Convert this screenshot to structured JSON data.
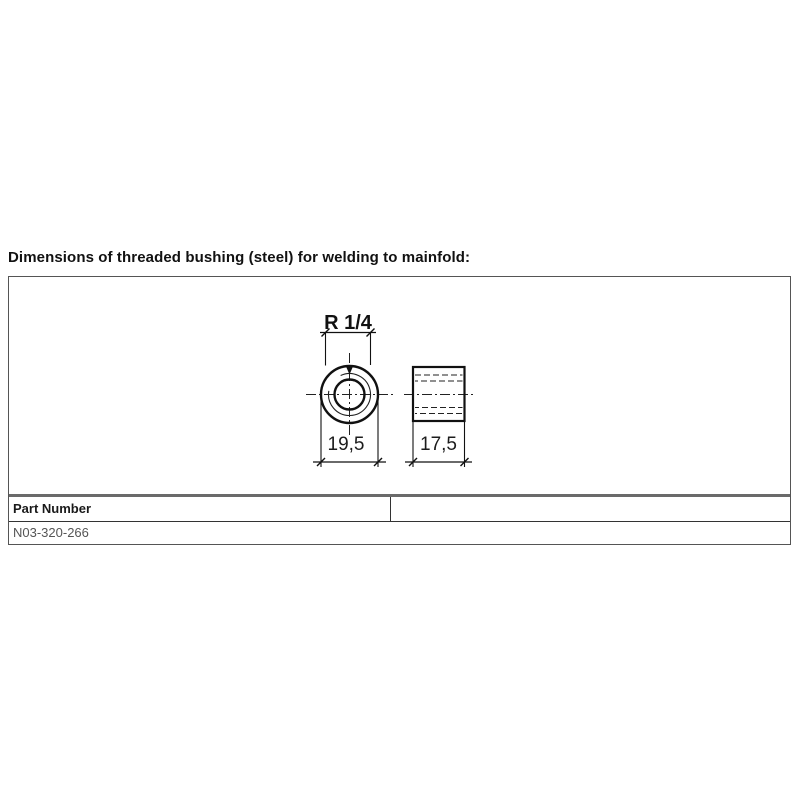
{
  "page": {
    "title": "Dimensions of threaded bushing (steel) for welding to mainfold:"
  },
  "drawing": {
    "thread_label": "R 1/4",
    "outer_diameter_label": "19,5",
    "width_label": "17,5",
    "views": [
      "front-view-circular",
      "side-view-rectangular"
    ]
  },
  "parts_table": {
    "header": "Part Number",
    "rows": [
      {
        "part_number": "N03-320-266"
      }
    ]
  },
  "colors": {
    "line": "#111111",
    "thin_line": "#222222",
    "frame_border": "#555555",
    "thick_separator": "#6a6a6a",
    "muted_text": "#555555",
    "background": "#ffffff"
  }
}
